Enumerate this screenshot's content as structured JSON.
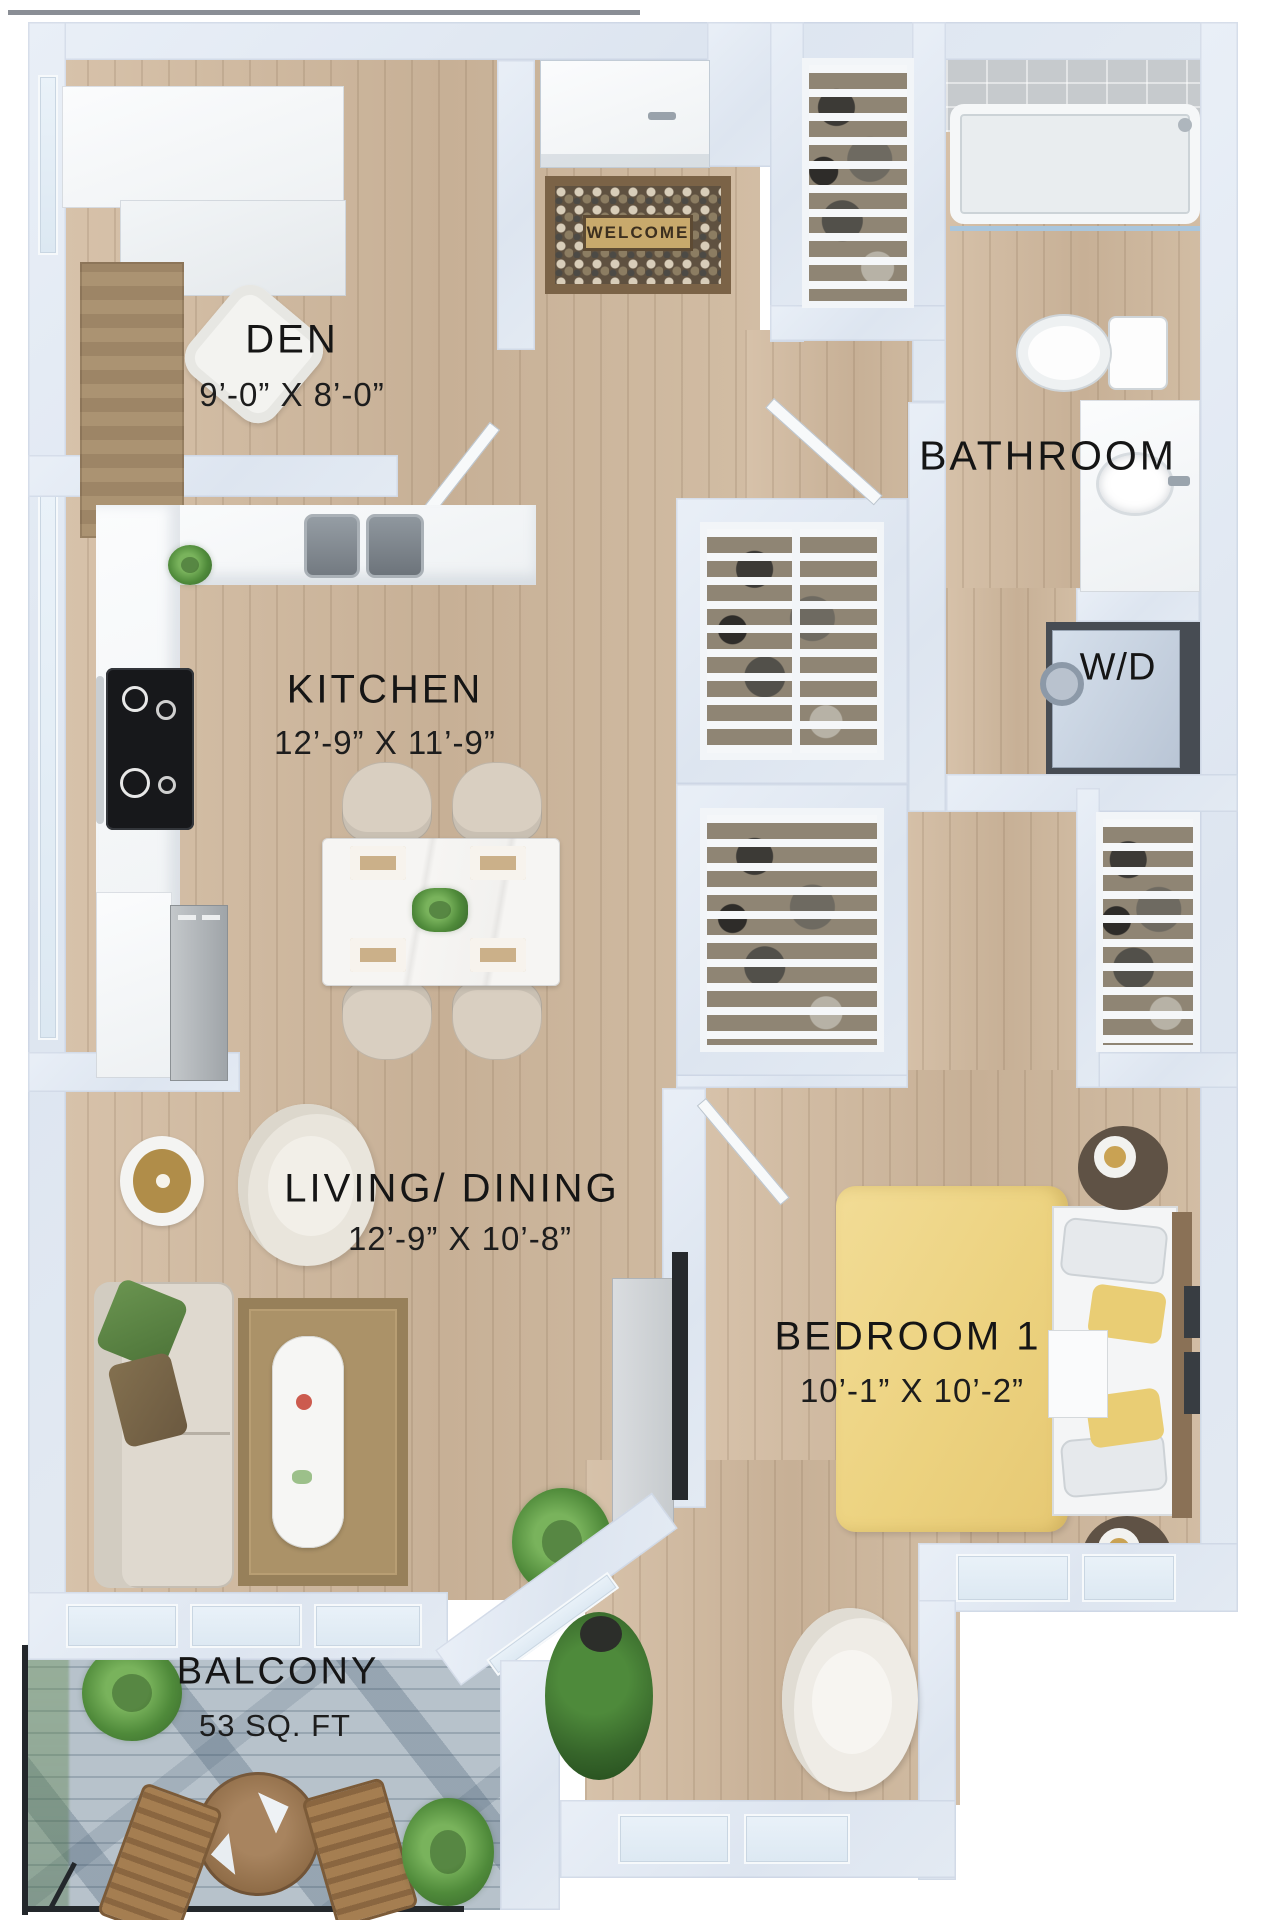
{
  "rooms": {
    "den": {
      "label": "DEN",
      "dims": "9’-0” X 8’-0”"
    },
    "kitchen": {
      "label": "KITCHEN",
      "dims": "12’-9” X 11’-9”"
    },
    "bathroom": {
      "label": "BATHROOM"
    },
    "laundry": {
      "label": "W/D"
    },
    "living": {
      "label": "LIVING/ DINING",
      "dims": "12’-9” X 10’-8”"
    },
    "bedroom": {
      "label": "BEDROOM 1",
      "dims": "10’-1” X 10’-2”"
    },
    "balcony": {
      "label": "BALCONY",
      "area": "53 SQ. FT"
    }
  },
  "entry": {
    "doormat_text": "WELCOME"
  },
  "colors": {
    "wall": "#e1e8f2",
    "floor_wood": "#cdb79e",
    "balcony_floor": "#b7c2cb",
    "bed_accent": "#eed584",
    "label_text": "#151515"
  }
}
